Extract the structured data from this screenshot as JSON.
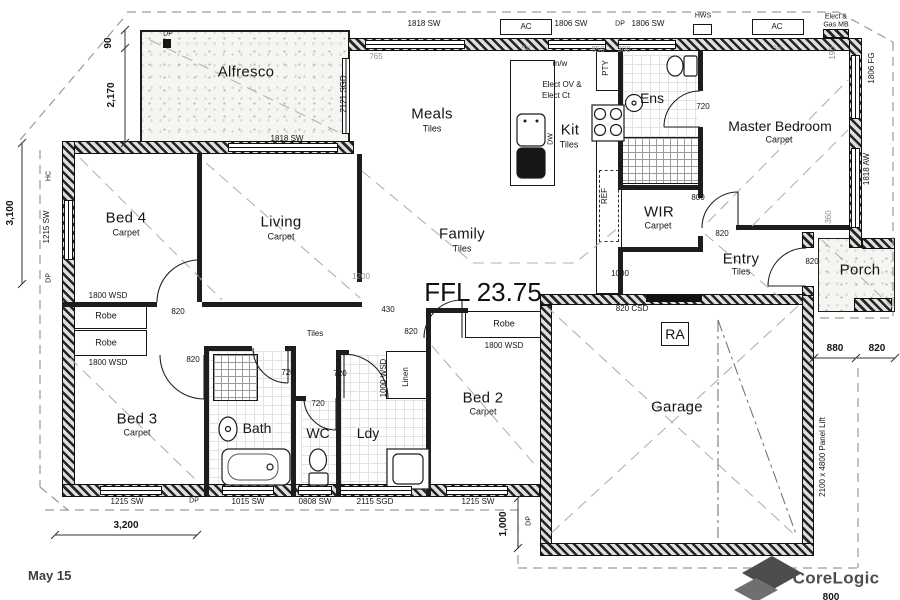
{
  "plan": {
    "ffl": "FFL 23.75",
    "date": "May 15",
    "brand": "CoreLogic",
    "rooms": {
      "alfresco": "Alfresco",
      "meals": "Meals",
      "meals_floor": "Tiles",
      "kit": "Kit",
      "kit_floor": "Tiles",
      "ens": "Ens",
      "master": "Master Bedroom",
      "master_floor": "Carpet",
      "bed4": "Bed 4",
      "bed4_floor": "Carpet",
      "living": "Living",
      "living_floor": "Carpet",
      "family": "Family",
      "family_floor": "Tiles",
      "wir": "WIR",
      "wir_floor": "Carpet",
      "entry": "Entry",
      "entry_floor": "Tiles",
      "porch": "Porch",
      "bed3": "Bed 3",
      "bed3_floor": "Carpet",
      "bath": "Bath",
      "wc": "WC",
      "ldy": "Ldy",
      "bed2": "Bed 2",
      "bed2_floor": "Carpet",
      "garage": "Garage",
      "hall_floor": "Tiles",
      "robe": "Robe",
      "linen": "Linen",
      "ra": "RA"
    },
    "codes": {
      "sw1818": "1818 SW",
      "sw1806": "1806 SW",
      "sgd2121": "2121 SGD",
      "sw1215": "1215 SW",
      "fg1806": "1806 FG",
      "aw1818": "1818 AW",
      "sw1015": "1015 SW",
      "sw0808": "0808 SW",
      "sgd2115": "2115 SGD",
      "wsd1800": "1800 WSD",
      "wsd1000": "1000 WSD",
      "d820": "820",
      "d720": "720",
      "d800": "800",
      "csd820": "820 CSD",
      "panel_lift": "2100 x 4800 Panel Lift"
    },
    "dims": {
      "d90": "90",
      "d2170": "2,170",
      "d3100": "3,100",
      "d3200": "3,200",
      "d1000": "1,000",
      "d1000b": "1000",
      "d765": "765",
      "d850": "850",
      "d300": "300",
      "d1200": "1200",
      "d430": "430",
      "d360": "360",
      "d190": "190",
      "d880": "880",
      "d820": "820",
      "d800": "800"
    },
    "services": {
      "ac": "AC",
      "dp": "DP",
      "hc": "HC",
      "hws": "HWS",
      "sv": "SV",
      "meter1": "Elect &",
      "meter2": "Gas MB",
      "mw": "m/w",
      "elect1": "Elect OV &",
      "elect2": "Elect Ct",
      "pty": "PTY",
      "ref": "REF",
      "dw": "DW"
    }
  }
}
